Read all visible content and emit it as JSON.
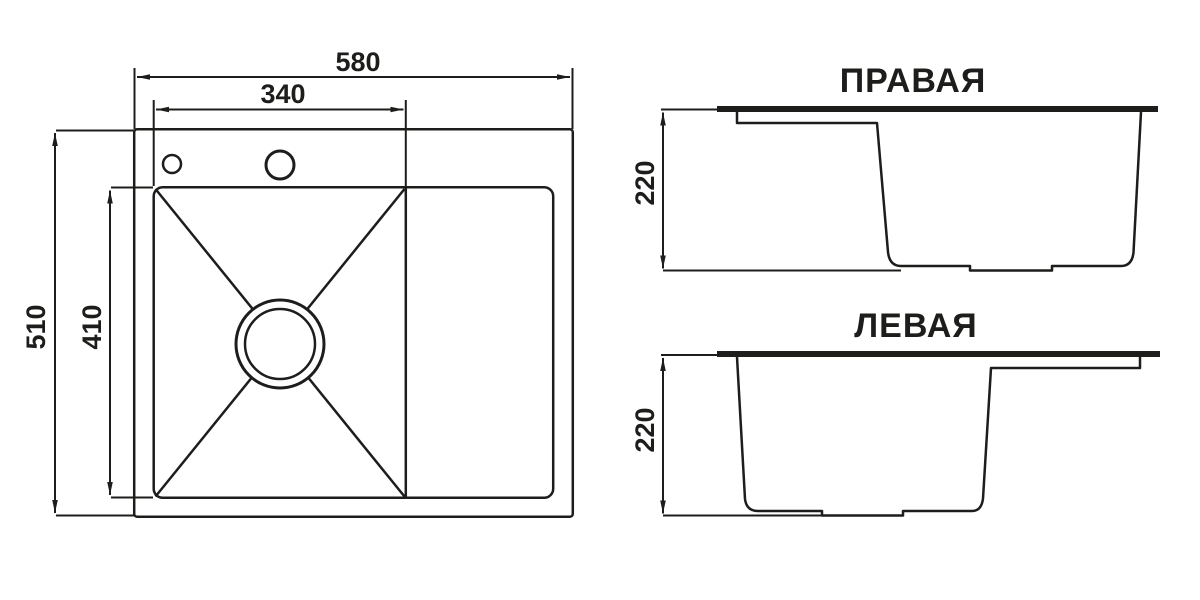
{
  "page": {
    "background": "#ffffff",
    "line_color": "#1d1d1b"
  },
  "top_view": {
    "dim_overall_width": "580",
    "dim_bowl_width": "340",
    "dim_overall_depth": "510",
    "dim_bowl_depth": "410"
  },
  "side_view_right": {
    "title": "ПРАВАЯ",
    "dim_depth": "220"
  },
  "side_view_left": {
    "title": "ЛЕВАЯ",
    "dim_depth": "220"
  }
}
